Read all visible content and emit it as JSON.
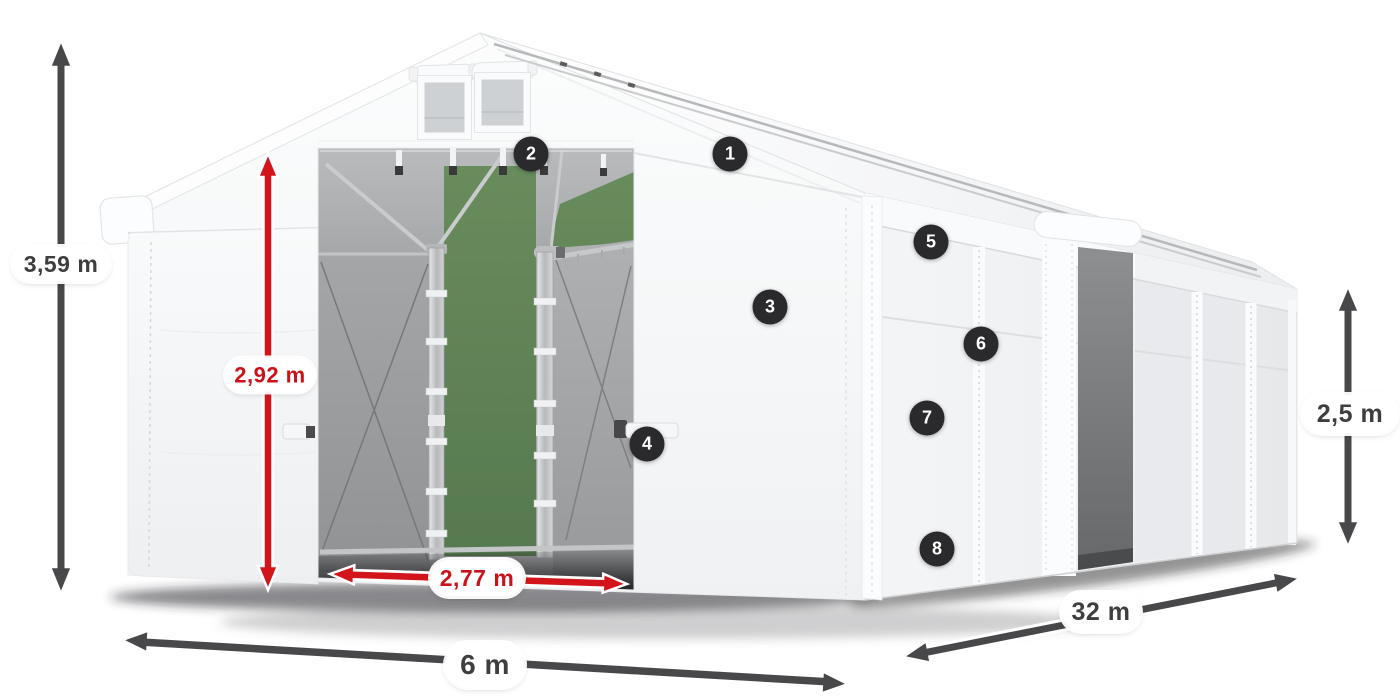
{
  "diagram": {
    "title": "storage-tent-dimension-diagram",
    "badges": [
      {
        "number": "1"
      },
      {
        "number": "2"
      },
      {
        "number": "3"
      },
      {
        "number": "4"
      },
      {
        "number": "5"
      },
      {
        "number": "6"
      },
      {
        "number": "7"
      },
      {
        "number": "8"
      }
    ],
    "dimensions": {
      "total_height": "3,59 m",
      "door_height": "2,92 m",
      "door_width": "2,77 m",
      "front_width": "6 m",
      "length": "32 m",
      "side_height": "2,5 m"
    },
    "colors": {
      "accent_red": "#d2151a",
      "arrow_gray": "#48484b",
      "badge_background": "#2a2a2c",
      "pass_through_green": "#5d7f55",
      "tent_white": "#f7f8f9",
      "interior_gray": "#a3a5a7"
    }
  }
}
